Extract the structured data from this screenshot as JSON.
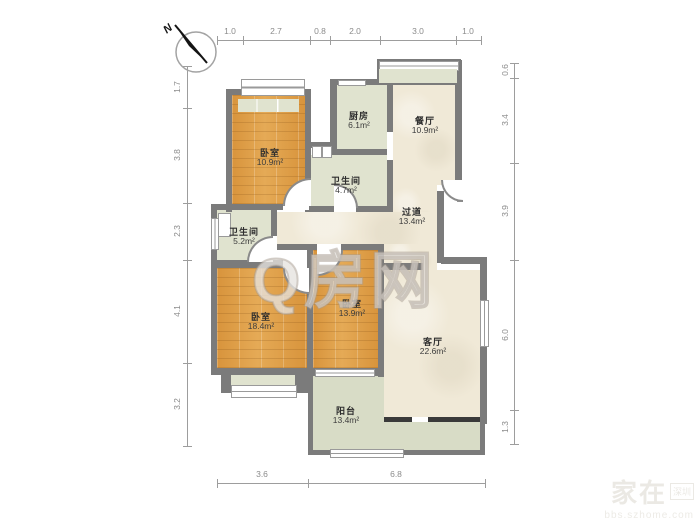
{
  "compass": {
    "north_label": "N"
  },
  "watermarks": {
    "center": "Q房网",
    "corner_main": "家在",
    "corner_badge": "深圳",
    "corner_sub": "bbs.szhome.com"
  },
  "rooms": [
    {
      "id": "bedroom-top-left",
      "name": "卧室",
      "area": "10.9m²"
    },
    {
      "id": "kitchen",
      "name": "厨房",
      "area": "6.1m²"
    },
    {
      "id": "dining",
      "name": "餐厅",
      "area": "10.9m²"
    },
    {
      "id": "bathroom-a",
      "name": "卫生间",
      "area": "4.7m²"
    },
    {
      "id": "hallway",
      "name": "过道",
      "area": "13.4m²"
    },
    {
      "id": "bathroom-b",
      "name": "卫生间",
      "area": "5.2m²"
    },
    {
      "id": "bedroom-bottom-left",
      "name": "卧室",
      "area": "18.4m²"
    },
    {
      "id": "bedroom-middle",
      "name": "卧室",
      "area": "13.9m²"
    },
    {
      "id": "living-room",
      "name": "客厅",
      "area": "22.6m²"
    },
    {
      "id": "balcony",
      "name": "阳台",
      "area": "13.4m²"
    }
  ],
  "dims": {
    "top": [
      "1.0",
      "2.7",
      "0.8",
      "2.0",
      "3.0",
      "1.0"
    ],
    "left": [
      "1.7",
      "3.8",
      "2.3",
      "4.1",
      "3.2"
    ],
    "right": [
      "0.6",
      "3.4",
      "3.9",
      "6.0",
      "1.3"
    ],
    "bottom": [
      "3.6",
      "6.8"
    ]
  },
  "colors": {
    "wall": "#7b7b7b",
    "wood_floor": "#e0a14c",
    "tile_floor": "#f0e9d7",
    "green_floor": "#e0e3cf",
    "balcony_floor": "#d8dcc6"
  }
}
